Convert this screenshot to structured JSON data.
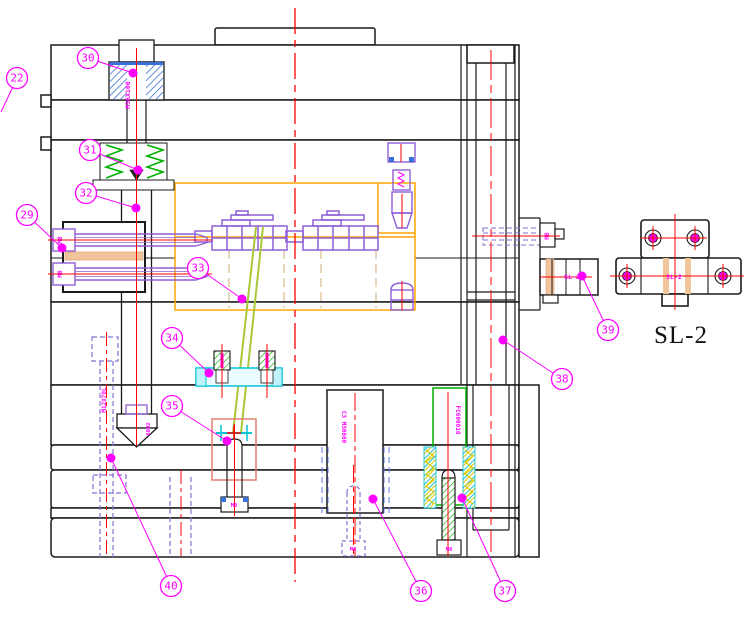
{
  "drawing": {
    "caption": "SL-2",
    "colors": {
      "balloon": "#ff00ff",
      "centerline": "#ff0000",
      "outline": "#1a1a1a",
      "purple": "#8f5fd6",
      "hidden_purple": "#8a6fd0",
      "blue": "#3a6fd8",
      "green": "#00b000",
      "lime": "#a8c838",
      "cyan": "#00c3d4",
      "orange": "#ffa500",
      "salmon": "#e08070",
      "tan": "#f2c49b",
      "tan_dash": "#d8bc8c",
      "yellow": "#d8c800"
    },
    "balloons": [
      {
        "label": "22",
        "cx": 17,
        "cy": 78,
        "tx": 1,
        "ty": 112,
        "dot": false
      },
      {
        "label": "29",
        "cx": 27,
        "cy": 215,
        "tx": 62,
        "ty": 248,
        "dot": true
      },
      {
        "label": "30",
        "cx": 88,
        "cy": 58,
        "tx": 133,
        "ty": 73,
        "dot": true
      },
      {
        "label": "31",
        "cx": 90,
        "cy": 150,
        "tx": 138,
        "ty": 170,
        "dot": true
      },
      {
        "label": "32",
        "cx": 86,
        "cy": 193,
        "tx": 136,
        "ty": 208,
        "dot": true
      },
      {
        "label": "33",
        "cx": 198,
        "cy": 268,
        "tx": 242,
        "ty": 299,
        "dot": true
      },
      {
        "label": "34",
        "cx": 172,
        "cy": 338,
        "tx": 209,
        "ty": 373,
        "dot": true
      },
      {
        "label": "35",
        "cx": 172,
        "cy": 406,
        "tx": 227,
        "ty": 441,
        "dot": true
      },
      {
        "label": "36",
        "cx": 421,
        "cy": 591,
        "tx": 373,
        "ty": 499,
        "dot": true
      },
      {
        "label": "37",
        "cx": 505,
        "cy": 591,
        "tx": 462,
        "ty": 498,
        "dot": true
      },
      {
        "label": "38",
        "cx": 562,
        "cy": 379,
        "tx": 503,
        "ty": 340,
        "dot": true
      },
      {
        "label": "39",
        "cx": 608,
        "cy": 330,
        "tx": 582,
        "ty": 276,
        "dot": true
      },
      {
        "label": "40",
        "cx": 171,
        "cy": 586,
        "tx": 111,
        "ty": 458,
        "dot": true
      }
    ],
    "labels": [
      {
        "name": "puller-bolt-spec",
        "text": "M36X100",
        "x": 130,
        "y": 95,
        "rot": -90,
        "size": 6.5
      },
      {
        "name": "clamp-bolt-size-top",
        "text": "M8",
        "x": 62,
        "y": 240,
        "rot": -90,
        "size": 6
      },
      {
        "name": "clamp-bolt-size-bottom",
        "text": "M8",
        "x": 62,
        "y": 274,
        "rot": -90,
        "size": 6
      },
      {
        "name": "wedge-bolt-size",
        "text": "M8",
        "x": 234,
        "y": 507,
        "rot": 0,
        "size": 5.5
      },
      {
        "name": "center-bolt-size",
        "text": "M8",
        "x": 353,
        "y": 551,
        "rot": 0,
        "size": 5.5
      },
      {
        "name": "guide-bolt-size",
        "text": "M8",
        "x": 449,
        "y": 551,
        "rot": 0,
        "size": 5.5
      },
      {
        "name": "stop-bolt-size",
        "text": "M8",
        "x": 549,
        "y": 236,
        "rot": -90,
        "size": 6
      },
      {
        "name": "hidden-bolt-spec",
        "text": "M12X70L",
        "x": 106,
        "y": 400,
        "rot": -90,
        "size": 6
      },
      {
        "name": "tip-part-code",
        "text": "6002",
        "x": 150,
        "y": 429,
        "rot": -90,
        "size": 5.5
      },
      {
        "name": "center-block-code",
        "text": "C3 M30600",
        "x": 342,
        "y": 427,
        "rot": 90,
        "size": 6
      },
      {
        "name": "guide-block-code",
        "text": "FC600010",
        "x": 456,
        "y": 420,
        "rot": 90,
        "size": 6
      },
      {
        "name": "slide-lock-tag",
        "text": "SL-2",
        "x": 572,
        "y": 279,
        "rot": 0,
        "size": 6.5
      },
      {
        "name": "slide-lock-detail-tag",
        "text": "SL-2",
        "x": 674,
        "y": 279,
        "rot": 0,
        "size": 6.5
      }
    ]
  }
}
